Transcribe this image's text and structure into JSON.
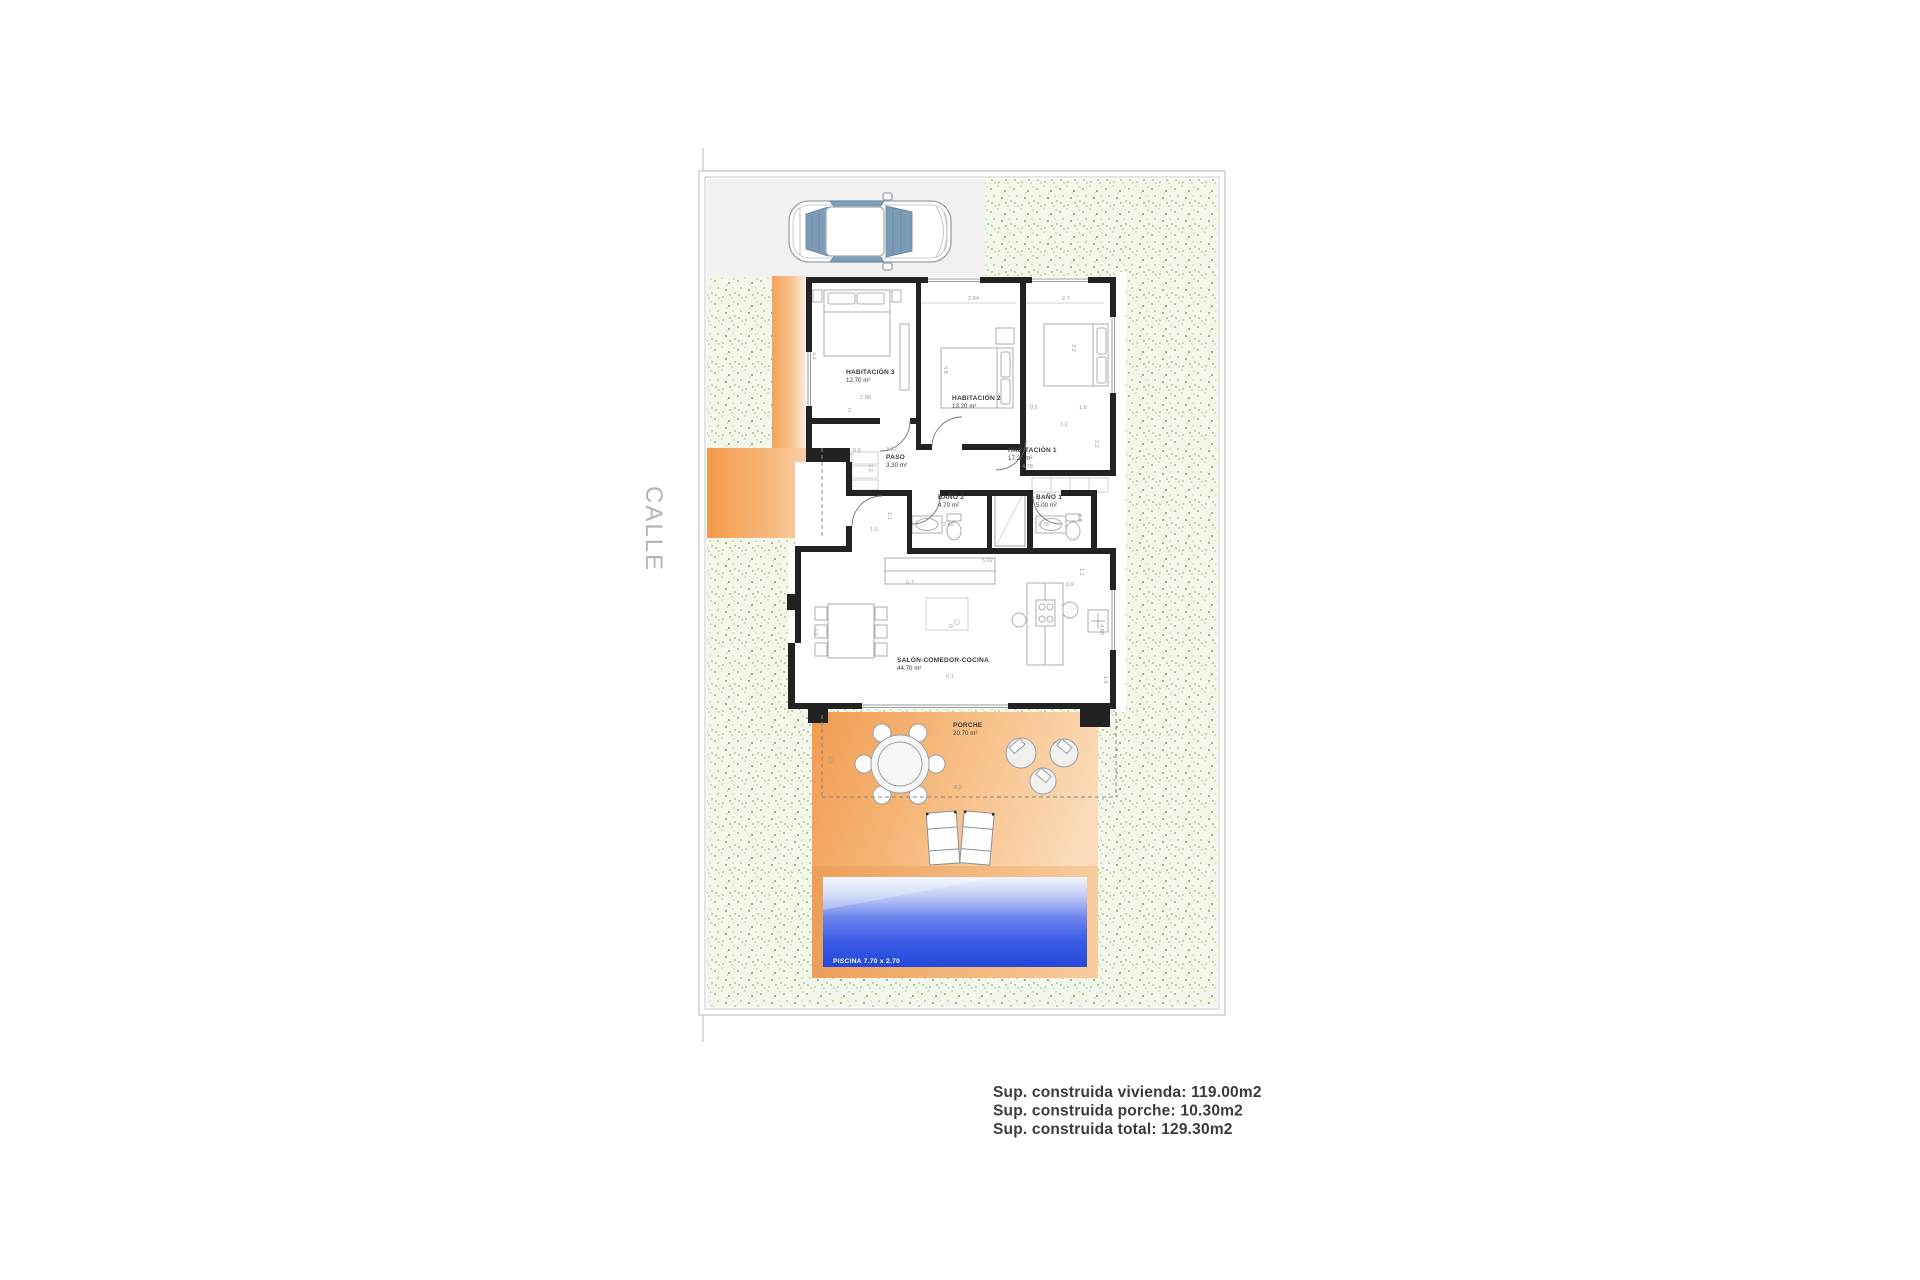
{
  "street_label": "CALLE",
  "rooms": [
    {
      "name": "HABITACIÓN 3",
      "area": "12.70 m²"
    },
    {
      "name": "HABITACIÓN 2",
      "area": "13.20 m²"
    },
    {
      "name": "HABITACIÓN 1",
      "area": "17.20 m²"
    },
    {
      "name": "PASO",
      "area": "3.30 m²"
    },
    {
      "name": "BAÑO 2",
      "area": "4.70 m²"
    },
    {
      "name": "BAÑO 1",
      "area": "5.00 m²"
    },
    {
      "name": "SALÓN-COMEDOR-COCINA",
      "area": "44.70 m²"
    },
    {
      "name": "PORCHE",
      "area": "20.70 m²"
    }
  ],
  "pool": {
    "label": "PISCINA 7.70 x 2.70"
  },
  "summary": {
    "vivienda": "Sup. construida vivienda: 119.00m2",
    "porche": "Sup. construida porche: 10.30m2",
    "total": "Sup. construida total: 129.30m2"
  },
  "dims": [
    {
      "t": "2.94"
    },
    {
      "t": "2.7"
    },
    {
      "t": "4.4"
    },
    {
      "t": "2.88"
    },
    {
      "t": "2"
    },
    {
      "t": "4.8"
    },
    {
      "t": "3.2"
    },
    {
      "t": "0.5"
    },
    {
      "t": "1.8"
    },
    {
      "t": "1.2"
    },
    {
      "t": "2.2"
    },
    {
      "t": "4.78"
    },
    {
      "t": "3.32"
    },
    {
      "t": "0.9"
    },
    {
      "t": "1.2"
    },
    {
      "t": "2.1"
    },
    {
      "t": "2.65"
    },
    {
      "t": "2.76"
    },
    {
      "t": "1.6"
    },
    {
      "t": "1.8"
    },
    {
      "t": "5.02"
    },
    {
      "t": "6.7"
    },
    {
      "t": "0.9"
    },
    {
      "t": "1.2"
    },
    {
      "t": "4.0"
    },
    {
      "t": "4.68"
    },
    {
      "t": "6.1"
    },
    {
      "t": "2.5"
    },
    {
      "t": "8.2"
    },
    {
      "t": "1.6"
    }
  ],
  "colors": {
    "terrace_orange": "#f2a159",
    "garden_green": "#a9c189",
    "pool_blue": "#2b52e2",
    "garage_gray": "#f1f1f2",
    "wall_black": "#222222"
  }
}
